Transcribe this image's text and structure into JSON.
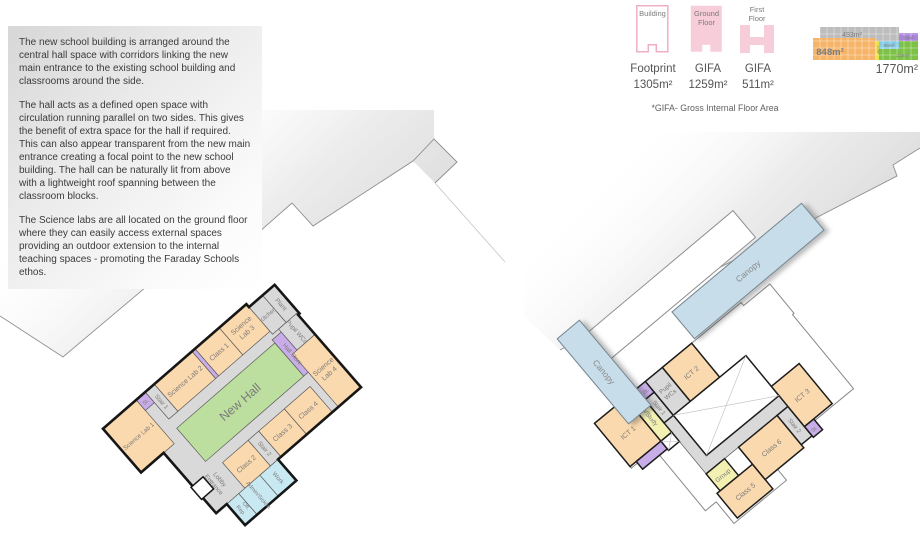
{
  "description": {
    "paragraphs": [
      "The new school building is arranged around the central hall space with corridors linking the new main entrance to the existing school building and classrooms around the side.",
      "The hall acts as a defined open space with circulation running parallel on two sides. This gives the benefit of extra space for the hall if required. This can also appear transparent from the new main entrance creating a focal point to the new school building.  The hall can be naturally lit from above with a lightweight roof spanning between the classroom blocks.",
      "The Science labs are all located on the ground floor where they can easily access external spaces providing an outdoor extension to the internal teaching spaces - promoting the Faraday Schools ethos."
    ]
  },
  "legend": {
    "building_icon_label": "Building",
    "ground_icon_label": [
      "Ground",
      "Floor"
    ],
    "first_icon_label": [
      "First",
      "Floor"
    ],
    "footprint_label": "Footprint",
    "footprint_area": "1305m²",
    "gifa_ground_label": "GIFA",
    "gifa_ground_area": "1259m²",
    "gifa_first_label": "GIFA",
    "gifa_first_area": "511m²",
    "footnote": "*GIFA- Gross Internal Floor Area"
  },
  "area_diagram": {
    "total": "1770m²",
    "segments": {
      "orange": "848m²",
      "gray": "493m²",
      "yellow": "47m²",
      "blue": "65m²",
      "purple": "56m²",
      "green": "228m²"
    }
  },
  "gf": {
    "science_lab_1": "Science Lab 1",
    "st": "St.",
    "stair_1": "Stair 1",
    "science_lab_2": "Science Lab 2",
    "class_1": "Class 1",
    "science_lab_3": [
      "Science",
      "Lab 3"
    ],
    "kitchen": "Kitchen",
    "plant": "Plant",
    "hall_store": "Hall Store",
    "pupil_wcs": "Pupil WCs",
    "science_lab_4": [
      "Science",
      "Lab 4"
    ],
    "new_hall": "New Hall",
    "entrance_lobby": [
      "Entrance",
      "Lobby"
    ],
    "class_2": "Class 2",
    "stair_2": "Stair 2",
    "class_3": "Class 3",
    "class_4": "Class 4",
    "rep_off": [
      "Rep.",
      "Off."
    ],
    "admin_sick_in": "Admin/Sick/In",
    "work": "Work"
  },
  "ff": {
    "ict_1": "ICT 1",
    "lib_study": "Lib/Study",
    "st_1": "St.",
    "stair_1": "Stair 1",
    "pupil_wcs": [
      "Pupil",
      "WCs"
    ],
    "ict_2": "ICT 2",
    "group": "Group",
    "class_5": "Class 5",
    "class_6": "Class 6",
    "stair_2": "Stair 2",
    "st_2": "St.",
    "ict_3": "ICT 3",
    "canopy_left": "Canopy",
    "canopy_top": "Canopy"
  },
  "palette": {
    "room_orange": "#FBD9AE",
    "hall_green": "#BCDF9F",
    "circulation_gray": "#D9D9D9",
    "store_purple": "#C9ADE8",
    "admin_cyan": "#C9E9F2",
    "study_yellow": "#F3F1B2",
    "canopy_blue": "#C8DDEA",
    "existing_gray": "#DCDCDC",
    "wall_dark": "#161616",
    "legend_pink": "#F7CDD9",
    "legend_pink_border": "#EFAFC2",
    "diag_orange": "#F6B469",
    "diag_gray": "#BDBDBD",
    "diag_yellow": "#E7E23E",
    "diag_blue": "#85CBE4",
    "diag_purple": "#AB84DC",
    "diag_green": "#7DC247"
  }
}
